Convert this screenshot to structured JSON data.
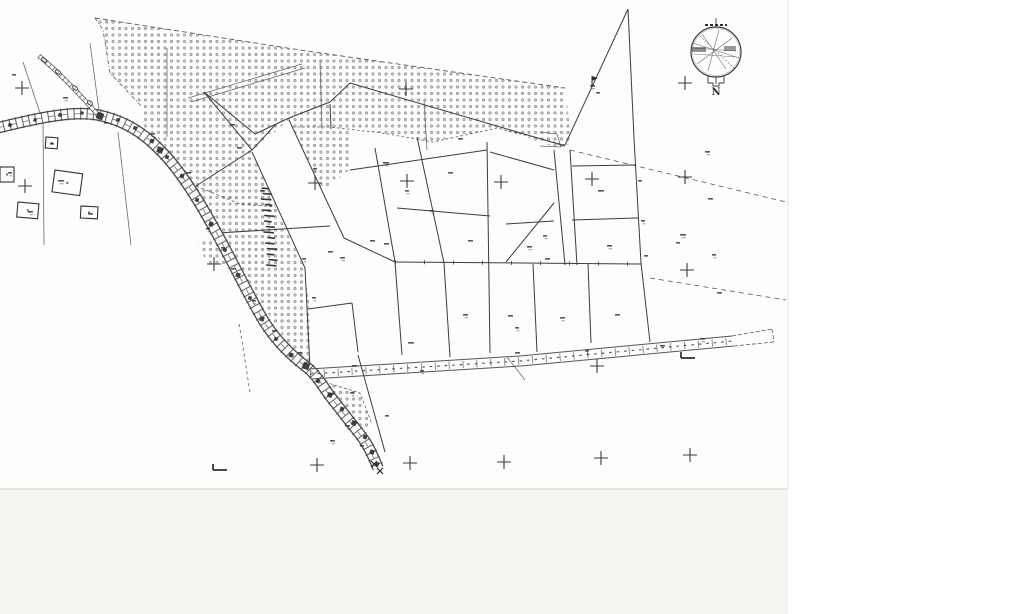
{
  "map": {
    "kind_label": "cadastral-survey-scan",
    "compass": {
      "label": "N"
    },
    "colors": {
      "paper": "#fdfdfb",
      "outside_right": "#ffffff",
      "outside_bottom": "#f5f5f2",
      "page_edge": "#d8d8d3",
      "ink": "#3c3c3c",
      "ink_light": "#6a6a6a",
      "ink_faint": "#8f8f8f",
      "smudge": "#2f2f2f"
    },
    "page": {
      "width": 788,
      "height": 489
    },
    "stipple": {
      "spacing": 6.5,
      "ring_radius": 1.15,
      "dot_radius": 0.35,
      "regions": {
        "orchard_top": "95,18 300,50 565,88 572,143 558,148 497,128 470,134 433,142 382,133 350,128 350,170 322,190 292,127 289,120 252,152 276,207 240,204 196,186 176,160 163,143 150,131 142,125 142,107 110,73 103,30",
        "road_band": "196,187 276,208 303,265 309,300 310,368 300,358 282,335 262,305 243,272 226,240 208,210",
        "west_patch": "197,238 232,247 240,268 206,263",
        "lower_fan": "325,382 360,393 372,424 362,432 335,405"
      }
    },
    "roads": {
      "main_center": "M -3,128 C 30,120 70,110 98,115 C 122,120 142,131 161,151 C 180,170 198,199 215,230 C 231,259 243,284 258,311 C 272,337 288,353 309,369 C 318,377 324,388 330,396 C 340,409 352,424 362,437 C 368,445 374,458 378,468",
      "branch_center": "M 39,56 C 55,69 76,90 99,116",
      "track_edge_top": "M 309,369 L 520,356 L 732,336",
      "track_edge_bottom": "M 311,379 L 521,366 L 734,346",
      "track_mid": "M 310,374 L 520,361 L 733,341"
    },
    "parcel_lines": [
      [
        204,
        92,
        255,
        134
      ],
      [
        255,
        134,
        289,
        118
      ],
      [
        289,
        118,
        330,
        102
      ],
      [
        330,
        102,
        350,
        83
      ],
      [
        350,
        83,
        565,
        146
      ],
      [
        330,
        104,
        331,
        129
      ],
      [
        204,
        92,
        252,
        150
      ],
      [
        252,
        150,
        196,
        186
      ],
      [
        252,
        150,
        276,
        124
      ],
      [
        252,
        152,
        305,
        268
      ],
      [
        289,
        120,
        344,
        238
      ],
      [
        305,
        268,
        310,
        368
      ],
      [
        308,
        309,
        352,
        303
      ],
      [
        352,
        303,
        358,
        352
      ],
      [
        358,
        355,
        385,
        452
      ],
      [
        218,
        233,
        330,
        226
      ],
      [
        344,
        238,
        395,
        262
      ],
      [
        375,
        148,
        395,
        262
      ],
      [
        395,
        262,
        402,
        355
      ],
      [
        417,
        137,
        444,
        263
      ],
      [
        444,
        263,
        450,
        357
      ],
      [
        487,
        142,
        490,
        353
      ],
      [
        350,
        170,
        487,
        150
      ],
      [
        397,
        208,
        490,
        216
      ],
      [
        490,
        152,
        554,
        170
      ],
      [
        554,
        150,
        565,
        265
      ],
      [
        570,
        150,
        577,
        265
      ],
      [
        572,
        166,
        635,
        165
      ],
      [
        572,
        220,
        638,
        218
      ],
      [
        506,
        224,
        554,
        221
      ],
      [
        554,
        203,
        506,
        262
      ],
      [
        395,
        262,
        641,
        264
      ],
      [
        533,
        264,
        537,
        352
      ],
      [
        588,
        264,
        591,
        343
      ],
      [
        565,
        145,
        628,
        9
      ],
      [
        628,
        9,
        634,
        138
      ],
      [
        634,
        138,
        641,
        263
      ],
      [
        641,
        263,
        650,
        342
      ]
    ],
    "aux_solid": [
      [
        23,
        62,
        43,
        122
      ],
      [
        43,
        122,
        44,
        245
      ],
      [
        90,
        43,
        100,
        118
      ],
      [
        118,
        132,
        131,
        245
      ],
      [
        167,
        48,
        167,
        137
      ],
      [
        320,
        60,
        322,
        129
      ],
      [
        188,
        98,
        302,
        64
      ],
      [
        191,
        102,
        305,
        68
      ],
      [
        424,
        100,
        427,
        150
      ],
      [
        507,
        357,
        525,
        380
      ],
      [
        540,
        132,
        557,
        134
      ],
      [
        557,
        134,
        561,
        147
      ],
      [
        540,
        146,
        561,
        147
      ]
    ],
    "aux_dashed": [
      {
        "d": "M95,18 L300,50 L565,88",
        "dash": "5 3",
        "w": 0.9
      },
      {
        "d": "M95,18 L103,30 L110,73 L142,107",
        "dash": "4 2 1 2",
        "w": 0.8
      },
      {
        "d": "M565,145 L497,128 L470,134 L433,142 L382,133 L330,127 L292,127",
        "dash": "2.5 2.5",
        "w": 0.8
      },
      {
        "d": "M196,186 L240,204 L276,207",
        "dash": "3 2.5",
        "w": 0.8
      },
      {
        "d": "M570,150 L786,202",
        "dash": "5 4",
        "w": 0.8
      },
      {
        "d": "M650,278 L786,300",
        "dash": "5 4",
        "w": 0.8
      },
      {
        "d": "M239,324 C243,345 246,368 250,392",
        "dash": "3 3",
        "w": 0.8
      },
      {
        "d": "M325,382 L360,393 L372,424",
        "dash": "3 2",
        "w": 0.7
      },
      {
        "d": "M335,405 L362,432",
        "dash": "3 2",
        "w": 0.7
      },
      {
        "d": "M732,336 L772,329 M734,346 L774,342 M772,329 L774,342",
        "dash": "4 2",
        "w": 0.8
      }
    ],
    "grid_crosses": [
      [
        22,
        88
      ],
      [
        406,
        89
      ],
      [
        685,
        83
      ],
      [
        25,
        186
      ],
      [
        315,
        183
      ],
      [
        407,
        181
      ],
      [
        501,
        182
      ],
      [
        592,
        179
      ],
      [
        685,
        177
      ],
      [
        214,
        264
      ],
      [
        687,
        270
      ],
      [
        597,
        366
      ],
      [
        317,
        465
      ],
      [
        410,
        463
      ],
      [
        504,
        462
      ],
      [
        601,
        458
      ],
      [
        690,
        455
      ]
    ],
    "survey_squares": [
      [
        10,
        125,
        1.8
      ],
      [
        35,
        120,
        1.6
      ],
      [
        60,
        115,
        1.8
      ],
      [
        82,
        113,
        1.6
      ],
      [
        100,
        116,
        3.4
      ],
      [
        118,
        120,
        1.8
      ],
      [
        135,
        128,
        1.8
      ],
      [
        152,
        141,
        2.0
      ],
      [
        160,
        150,
        3.0
      ],
      [
        167,
        157,
        1.8
      ],
      [
        182,
        176,
        2.0
      ],
      [
        197,
        200,
        1.8
      ],
      [
        211,
        224,
        2.2
      ],
      [
        225,
        250,
        1.8
      ],
      [
        238,
        275,
        2.2
      ],
      [
        250,
        298,
        1.8
      ],
      [
        262,
        319,
        2.2
      ],
      [
        276,
        339,
        1.8
      ],
      [
        291,
        355,
        2.2
      ],
      [
        306,
        366,
        3.4
      ],
      [
        318,
        381,
        2.0
      ],
      [
        330,
        395,
        2.4
      ],
      [
        342,
        409,
        2.0
      ],
      [
        354,
        423,
        2.4
      ],
      [
        365,
        437,
        2.0
      ],
      [
        372,
        452,
        2.2
      ],
      [
        377,
        464,
        2.0
      ]
    ],
    "station_ellipses": [
      [
        44,
        60
      ],
      [
        58,
        72
      ],
      [
        75,
        88
      ],
      [
        90,
        103
      ]
    ],
    "buildings": [
      {
        "x": 55,
        "y": 170,
        "w": 28,
        "h": 22,
        "rot": 8
      },
      {
        "x": 18,
        "y": 202,
        "w": 21,
        "h": 15,
        "rot": 5
      },
      {
        "x": 81,
        "y": 206,
        "w": 17,
        "h": 12,
        "rot": 3
      },
      {
        "x": 0,
        "y": 167,
        "w": 14,
        "h": 15,
        "rot": 0
      },
      {
        "x": 46,
        "y": 137,
        "w": 12,
        "h": 11,
        "rot": 4
      }
    ],
    "label_marks": [
      [
        58,
        180,
        5
      ],
      [
        88,
        213,
        4
      ],
      [
        28,
        211,
        4
      ],
      [
        50,
        143,
        3
      ],
      [
        8,
        172,
        3
      ],
      [
        12,
        74,
        3
      ],
      [
        63,
        97,
        4
      ],
      [
        104,
        122,
        3
      ],
      [
        150,
        133,
        4
      ],
      [
        186,
        172,
        4
      ],
      [
        206,
        228,
        3
      ],
      [
        231,
        268,
        4
      ],
      [
        252,
        300,
        3
      ],
      [
        272,
        330,
        4
      ],
      [
        298,
        352,
        3
      ],
      [
        230,
        124,
        4
      ],
      [
        313,
        168,
        3
      ],
      [
        328,
        251,
        4
      ],
      [
        302,
        258,
        3
      ],
      [
        221,
        247,
        3
      ],
      [
        260,
        190,
        4
      ],
      [
        237,
        147,
        4
      ],
      [
        383,
        162,
        5
      ],
      [
        458,
        138,
        4
      ],
      [
        405,
        190,
        3
      ],
      [
        448,
        172,
        4
      ],
      [
        430,
        210,
        3
      ],
      [
        468,
        240,
        4
      ],
      [
        527,
        246,
        4
      ],
      [
        598,
        190,
        5
      ],
      [
        607,
        245,
        4
      ],
      [
        545,
        258,
        4
      ],
      [
        543,
        235,
        3
      ],
      [
        370,
        240,
        4
      ],
      [
        340,
        257,
        4
      ],
      [
        384,
        243,
        4
      ],
      [
        312,
        297,
        3
      ],
      [
        408,
        342,
        5
      ],
      [
        463,
        314,
        4
      ],
      [
        508,
        315,
        4
      ],
      [
        560,
        317,
        4
      ],
      [
        615,
        314,
        4
      ],
      [
        515,
        327,
        3
      ],
      [
        352,
        365,
        4
      ],
      [
        420,
        370,
        3
      ],
      [
        515,
        352,
        4
      ],
      [
        585,
        350,
        3
      ],
      [
        660,
        345,
        4
      ],
      [
        700,
        338,
        4
      ],
      [
        330,
        393,
        4
      ],
      [
        350,
        392,
        3
      ],
      [
        385,
        415,
        3
      ],
      [
        345,
        425,
        4
      ],
      [
        360,
        445,
        3
      ],
      [
        330,
        440,
        4
      ],
      [
        638,
        180,
        3
      ],
      [
        641,
        220,
        3
      ],
      [
        644,
        255,
        3
      ],
      [
        680,
        234,
        5
      ],
      [
        676,
        242,
        3
      ],
      [
        590,
        85,
        4
      ],
      [
        596,
        92,
        3
      ],
      [
        705,
        151,
        4
      ],
      [
        708,
        198,
        4
      ],
      [
        712,
        254,
        3
      ],
      [
        717,
        292,
        4
      ]
    ],
    "ladder": {
      "x": 266,
      "y1": 188,
      "y2": 266,
      "step": 5.5,
      "w": 9
    },
    "x_marks": [
      [
        374,
        464
      ],
      [
        380,
        471
      ]
    ],
    "l_marks": [
      [
        220,
        470
      ],
      [
        688,
        358
      ]
    ],
    "flag": [
      592,
      80
    ]
  }
}
